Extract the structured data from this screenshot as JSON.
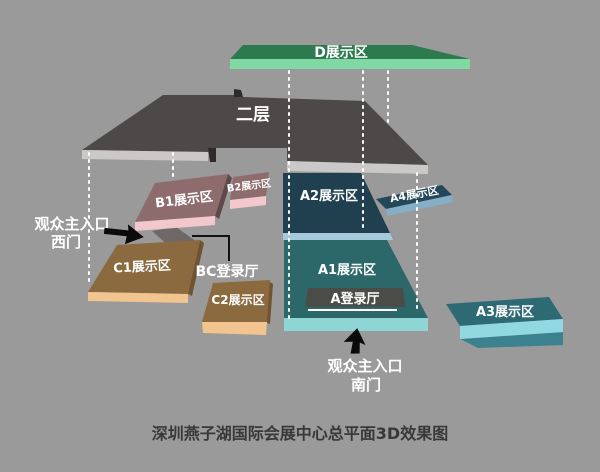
{
  "title": "深圳燕子湖国际会展中心总平面3D效果图",
  "colors": {
    "background": "#9a9a9a",
    "d_top": "#2d7a4e",
    "d_front": "#80d8a2",
    "floor2_top": "#4e4949",
    "floor2_front": "#cbc8c8",
    "floor2_dark": "#2f2b2b",
    "ramp": "#6e6867",
    "b_top": "#8e6c6e",
    "b_front": "#f2c8cc",
    "b_side": "#5f474a",
    "a2_top": "#20404f",
    "a2_front": "#a5c8db",
    "a1_top": "#2c686a",
    "a1_front": "#8fd5d5",
    "hall_strip": "#4b4b47",
    "a4_top": "#25475a",
    "a4_front": "#85aec7",
    "a3_top": "#2d6a74",
    "a3_front": "#90d9e0",
    "a3_side": "#3c828e",
    "c_top": "#8a6a3e",
    "c_front": "#f2c48f",
    "c_side": "#6f5330",
    "arrow": "#0a0a0a",
    "caption": "#383838"
  },
  "areas": {
    "d": {
      "label": "D展示区"
    },
    "floor2": {
      "label": "二层"
    },
    "b1": {
      "label": "B1展示区"
    },
    "b2": {
      "label": "B2展示区"
    },
    "a2": {
      "label": "A2展示区"
    },
    "a4": {
      "label": "A4展示区"
    },
    "a1": {
      "label": "A1展示区"
    },
    "a_hall": {
      "label": "A登录厅"
    },
    "bc_hall": {
      "label": "BC登录厅"
    },
    "c1": {
      "label": "C1展示区"
    },
    "c2": {
      "label": "C2展示区"
    },
    "a3": {
      "label": "A3展示区"
    }
  },
  "entrances": {
    "west": {
      "line1": "观众主入口",
      "line2": "西门"
    },
    "south": {
      "line1": "观众主入口",
      "line2": "南门"
    }
  }
}
